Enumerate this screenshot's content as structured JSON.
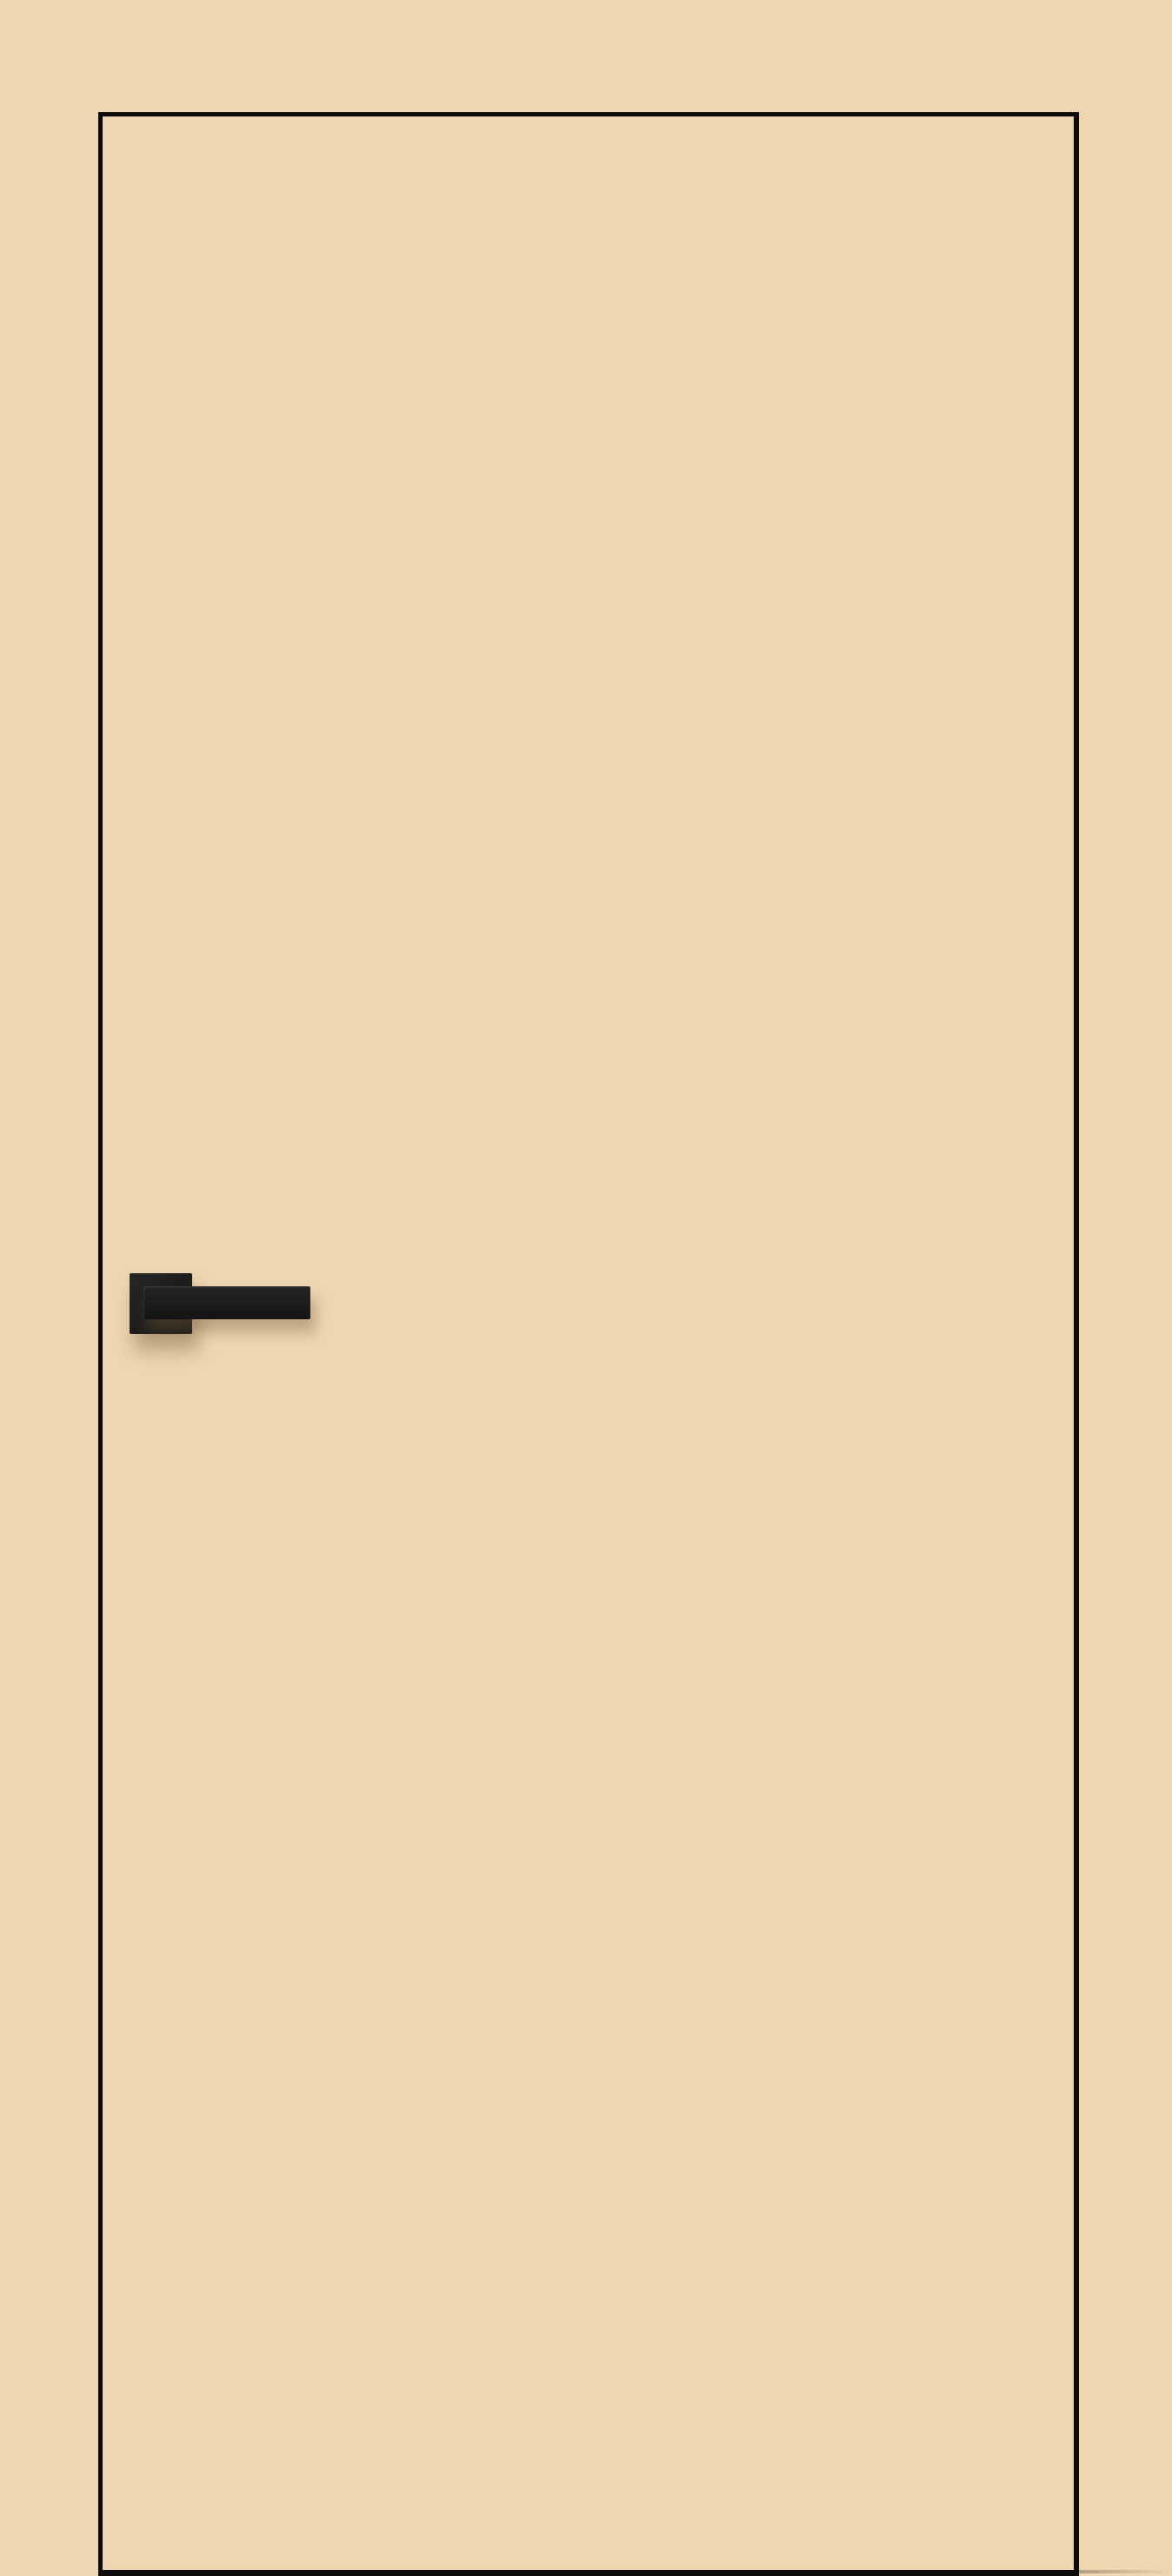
{
  "meta": {
    "subject": "Beige flush interior door with black edge trim and black lever handle",
    "text_content": "none"
  },
  "colors": {
    "page-bg": "#eed6b1",
    "door-face": "#eed6b1",
    "trim": "#0c0b09",
    "handle-dark": "#1b1b1b",
    "handle-mid": "#262626",
    "handle-highlight": "rgba(255,255,255,0.10)",
    "shadow": "rgba(120, 92, 58, 0.40)",
    "floor-line": "rgba(128, 114, 90, 0.55)"
  },
  "objects": {
    "door": "door-panel",
    "handle_plate": "door-handle-rosette",
    "handle_bar": "door-handle-lever",
    "floor_shadow": "floor-shadow-line"
  }
}
